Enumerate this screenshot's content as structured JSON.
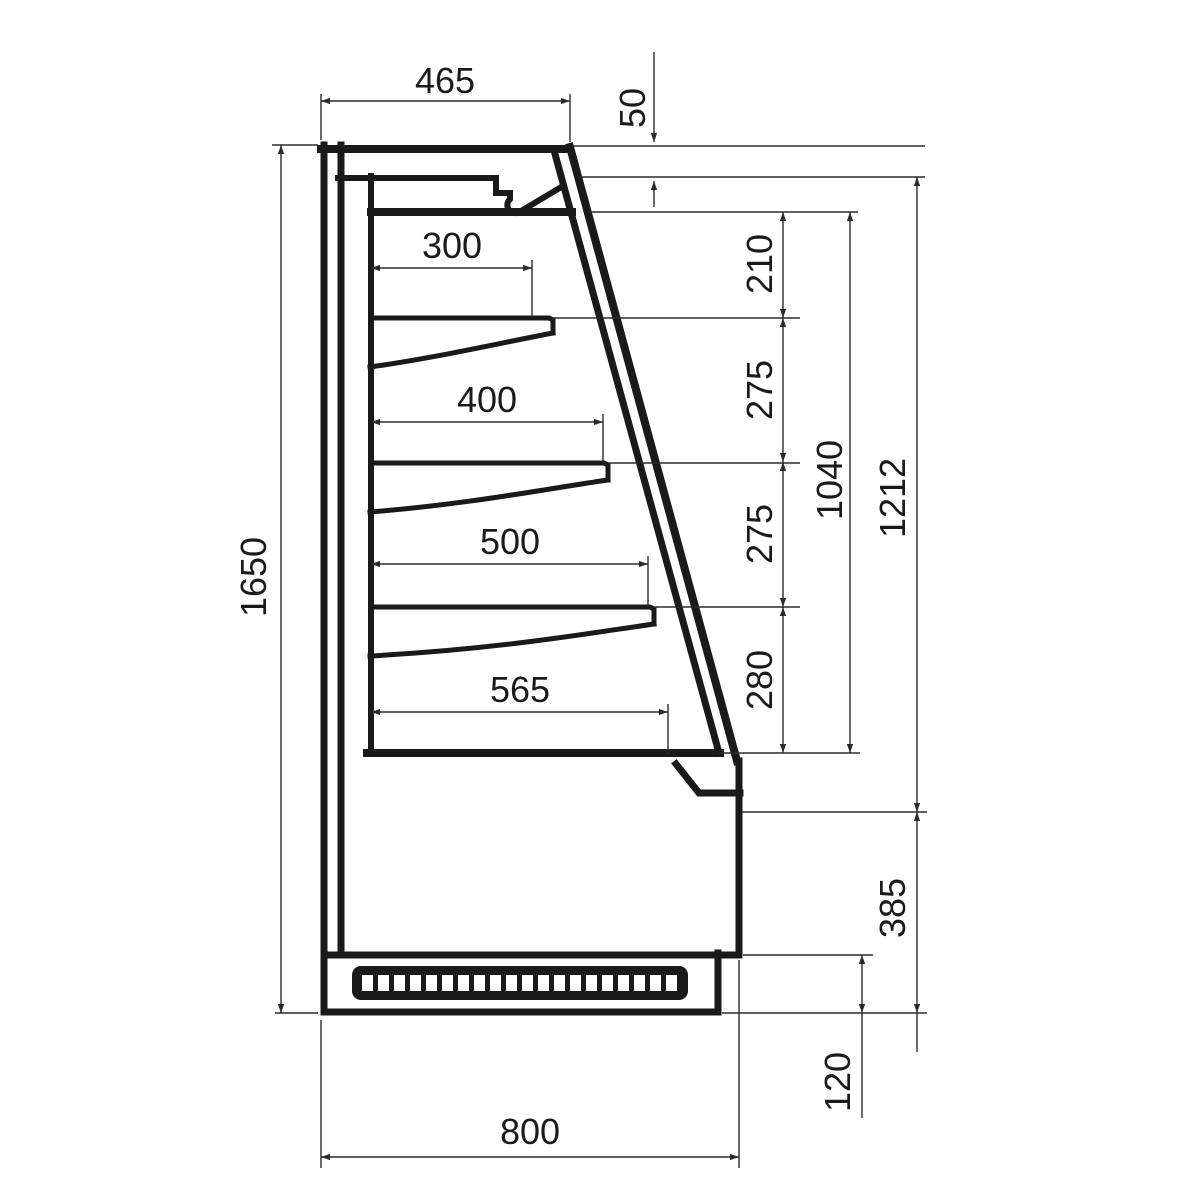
{
  "drawing": {
    "type": "side-section technical drawing of an open-front refrigerated display cabinet",
    "dims": {
      "width_top": "465",
      "canopy_drop": "50",
      "height_overall": "1650",
      "shelf1_depth": "300",
      "shelf2_depth": "400",
      "shelf3_depth": "500",
      "deck_depth": "565",
      "gap_canopy_shelf1": "210",
      "gap_shelf1_shelf2": "275",
      "gap_shelf2_shelf3": "275",
      "gap_shelf3_deck": "280",
      "interior_height": "1040",
      "front_height": "1212",
      "base_height": "385",
      "plinth_height": "120",
      "depth_overall": "800"
    },
    "colors": {
      "line": "#1a1a1c",
      "dim_line": "#2b2b2b",
      "text": "#1a1a1a",
      "background": "#ffffff"
    }
  }
}
